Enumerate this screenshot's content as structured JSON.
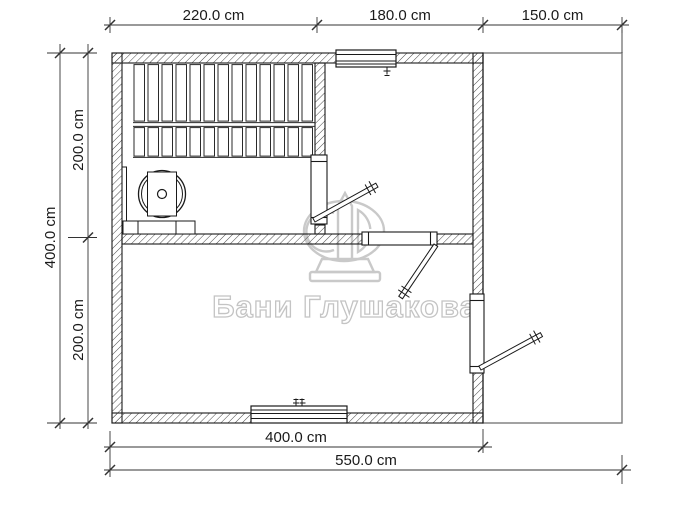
{
  "watermark": {
    "text": "Бани Глушакова",
    "color": "#c8c8c8"
  },
  "dimensions": {
    "unit": "cm",
    "top": [
      "220.0 cm",
      "180.0 cm",
      "150.0 cm"
    ],
    "left_total": "400.0 cm",
    "left_segments": [
      "200.0 cm",
      "200.0 cm"
    ],
    "bottom_inner": "400.0 cm",
    "bottom_total": "550.0 cm"
  },
  "measurements_cm": {
    "top_segments": [
      220.0,
      180.0,
      150.0
    ],
    "left_total": 400.0,
    "left_segments": [
      200.0,
      200.0
    ],
    "bottom_inner": 400.0,
    "bottom_total": 550.0
  },
  "plan_elements": [
    "hatched exterior and interior walls",
    "sauna bench slats (two rows)",
    "round tub with plank and platform",
    "door sauna to hall",
    "door hall to lower room",
    "door lower room to terrace",
    "window in top wall",
    "window in bottom wall",
    "open terrace outline"
  ],
  "colors": {
    "line": "#1a1a1a",
    "hatch": "#4a4a4a",
    "dimension_line": "#333333",
    "watermark": "#c8c8c8",
    "terrace_line": "#7a7a7a",
    "background": "#ffffff"
  }
}
